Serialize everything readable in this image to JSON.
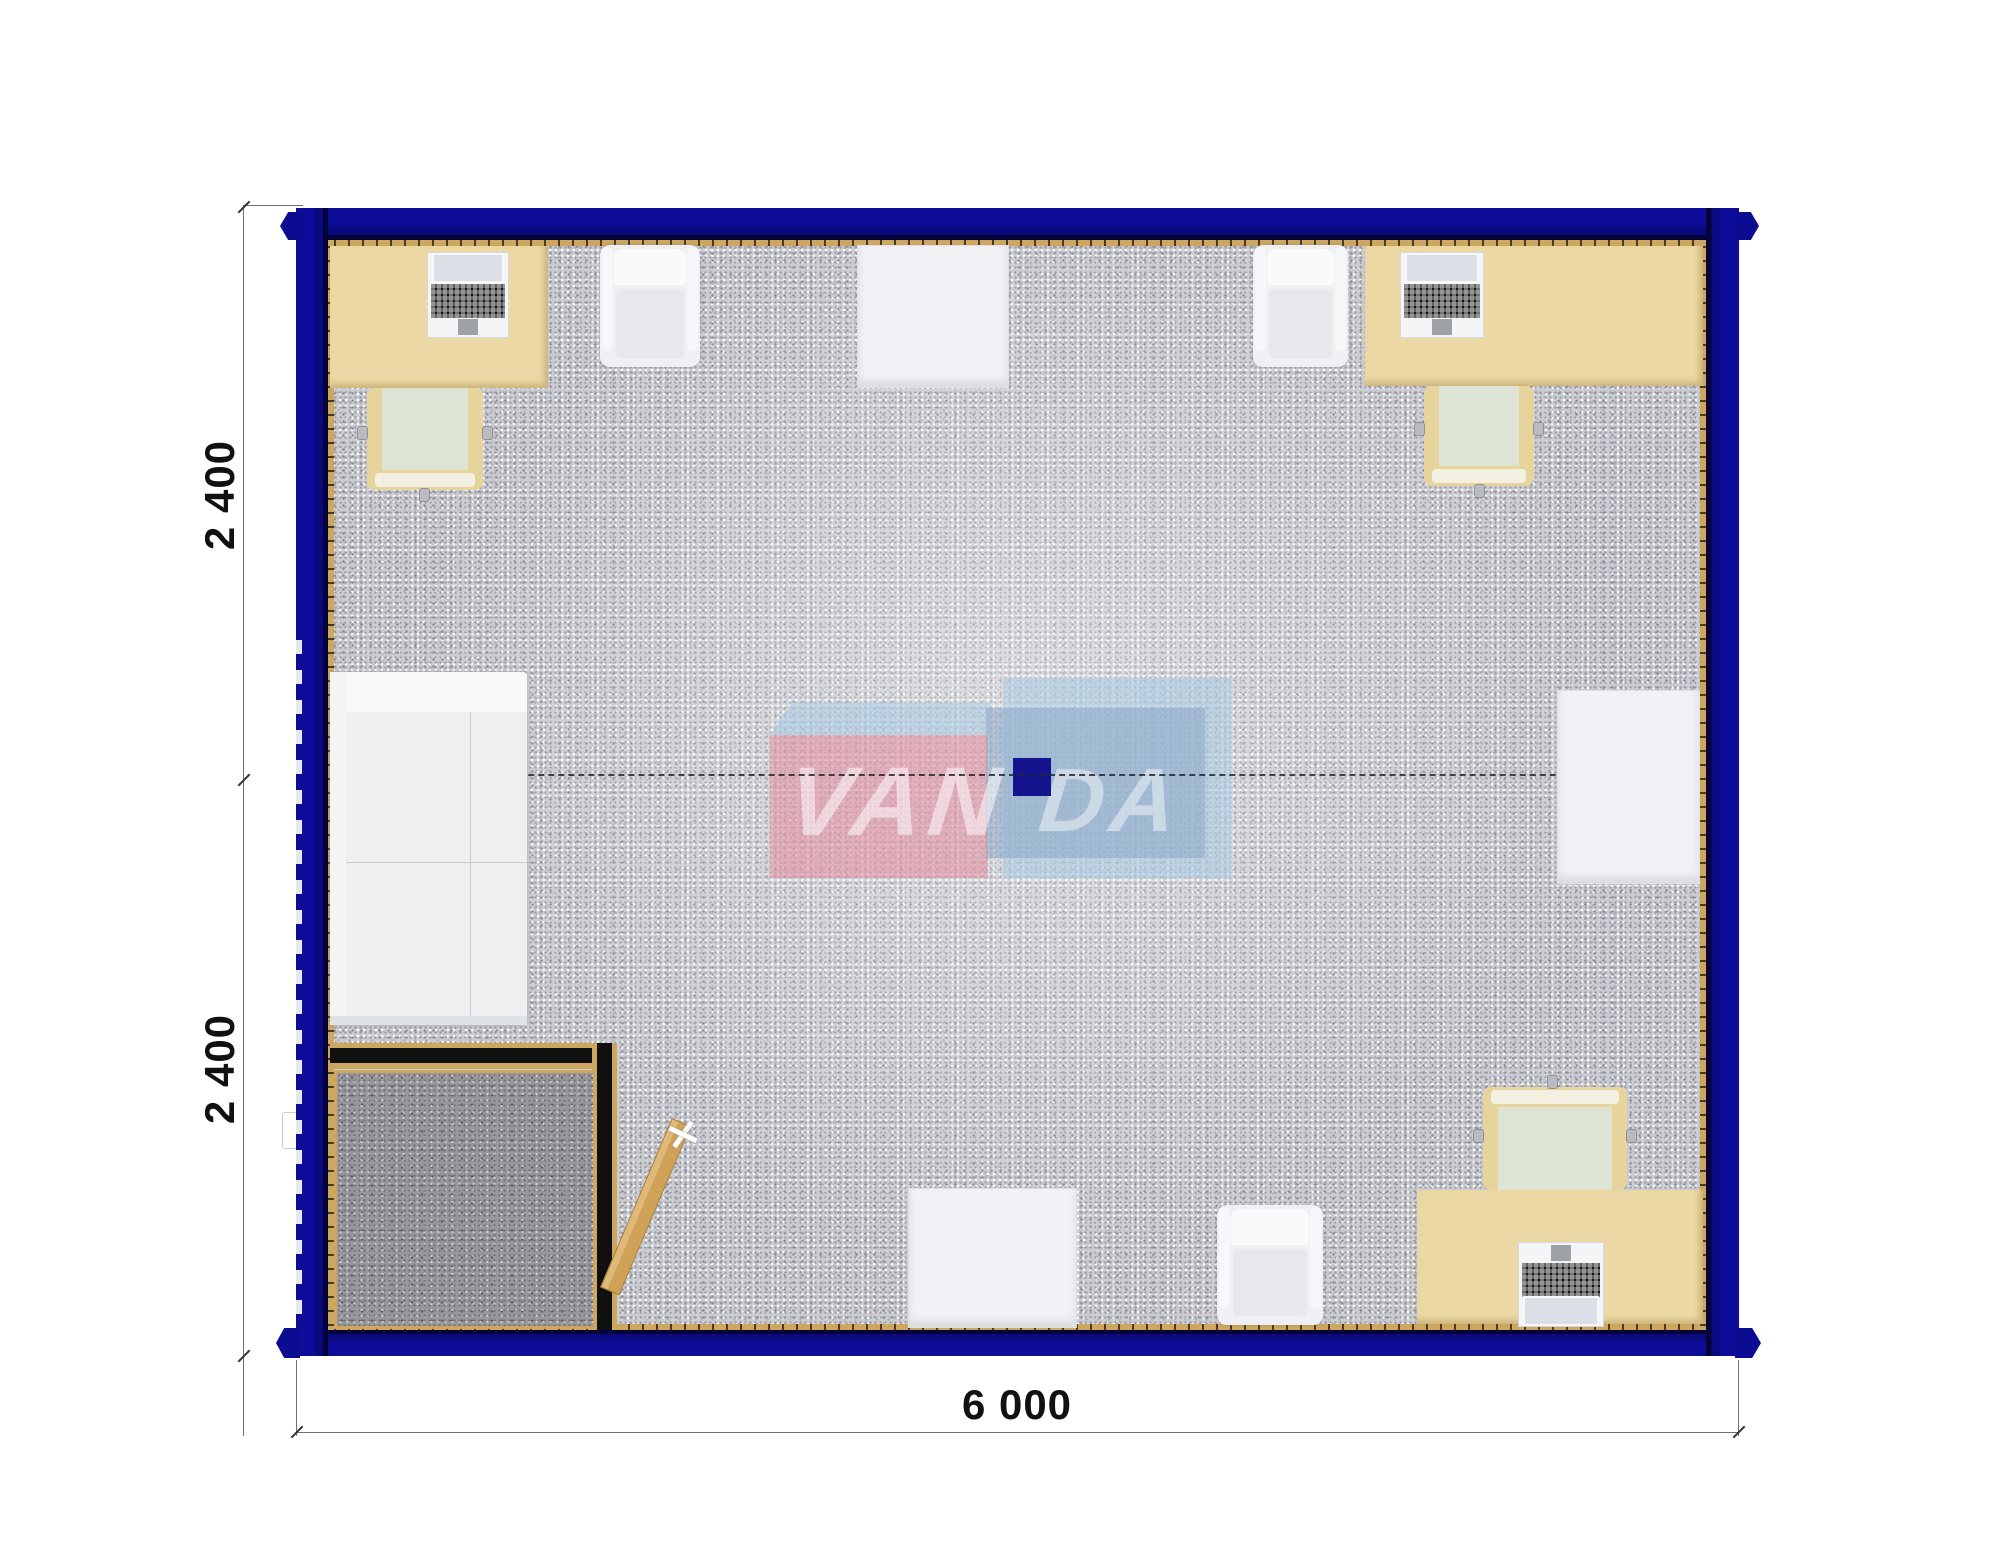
{
  "title": "Modular office container floor plan",
  "dimensions": {
    "left_top": "2 400",
    "left_bottom": "2 400",
    "bottom": "6 000"
  },
  "watermark": {
    "part1": "VAN",
    "part2": "DA"
  },
  "colors": {
    "wall_navy": "#0c0c93",
    "trim_gold": "#cda65f",
    "desk_beige": "#ebd8a4",
    "floor_gray": "#cbccd2",
    "entry_floor_gray": "#98989c",
    "logo_pink": "#e48fa0",
    "logo_light_blue": "#a9cce3",
    "logo_steel_blue": "#8fa9c8",
    "logo_navy_square": "#14148f",
    "chair_seat_sage": "#dde4d3",
    "furniture_white": "#eff0f3"
  }
}
